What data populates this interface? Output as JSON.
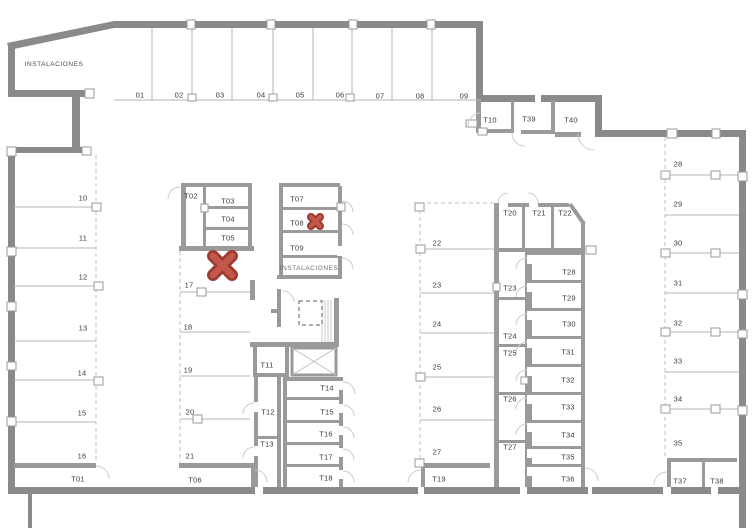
{
  "colors": {
    "wall": "#8a8a8a",
    "interior_wall": "#9a9a9a",
    "cross_fill": "#c2584b",
    "cross_outline": "#9e3b31"
  },
  "labels": {
    "inst_nw": "INSTALACIONES",
    "inst_core": "INSTALACIONES",
    "s01": "01",
    "s02": "02",
    "s03": "03",
    "s04": "04",
    "s05": "05",
    "s06": "06",
    "s07": "07",
    "s08": "08",
    "s09": "09",
    "t10": "T10",
    "t39": "T39",
    "t40": "T40",
    "s10": "10",
    "s11": "11",
    "s12": "12",
    "s13": "13",
    "s14": "14",
    "s15": "15",
    "s16": "16",
    "t01": "T01",
    "t02": "T02",
    "t03": "T03",
    "t04": "T04",
    "t05": "T05",
    "s17": "17",
    "s18": "18",
    "s19": "19",
    "s20": "20",
    "s21": "21",
    "t06": "T06",
    "t07": "T07",
    "t08": "T08",
    "t09": "T09",
    "t11": "T11",
    "t12": "T12",
    "t13": "T13",
    "t14": "T14",
    "t15": "T15",
    "t16": "T16",
    "t17": "T17",
    "t18": "T18",
    "s22": "22",
    "s23": "23",
    "s24": "24",
    "s25": "25",
    "s26": "26",
    "s27": "27",
    "t19": "T19",
    "t20": "T20",
    "t21": "T21",
    "t22": "T22",
    "t23": "T23",
    "t24": "T24",
    "t25": "T25",
    "t26": "T26",
    "t27": "T27",
    "t28": "T28",
    "t29": "T29",
    "t30": "T30",
    "t31": "T31",
    "t32": "T32",
    "t33": "T33",
    "t34": "T34",
    "t35": "T35",
    "t36": "T36",
    "s28": "28",
    "s29": "29",
    "s30": "30",
    "s31": "31",
    "s32": "32",
    "s33": "33",
    "s34": "34",
    "s35": "35",
    "t37": "T37",
    "t38": "T38"
  }
}
